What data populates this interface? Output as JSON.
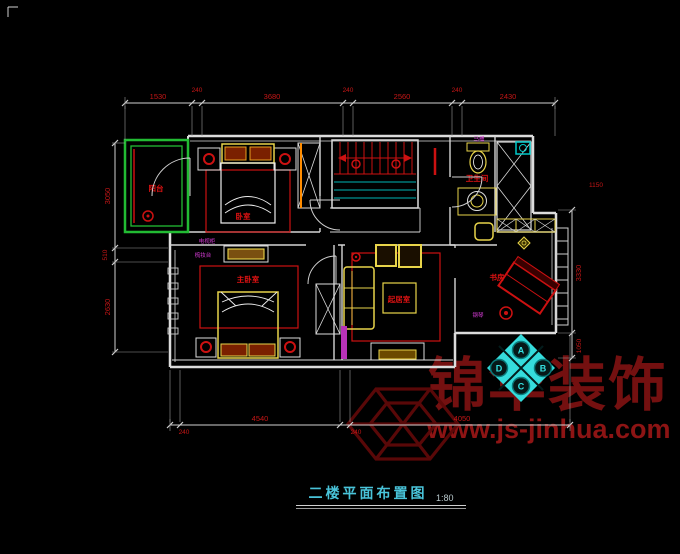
{
  "title": {
    "text": "二楼平面布置图",
    "scale": "1:80"
  },
  "watermark": {
    "brand": "锦华装饰",
    "site": "www.js-jinhua.com"
  },
  "compass": {
    "a": "A",
    "b": "B",
    "c": "C",
    "d": "D"
  },
  "rooms": {
    "balcony": "阳台",
    "bedroom": "卧室",
    "bathroom": "卫生间",
    "study": "书房",
    "family": "起居室",
    "master": "主卧室"
  },
  "annotations": {
    "toilet": "马桶",
    "tv_cabinet": "电视柜",
    "dresser": "梳妆台",
    "piano": "钢琴"
  },
  "dims": {
    "top": [
      "1530",
      "240",
      "3680",
      "240",
      "2560",
      "240",
      "2430"
    ],
    "bottom": [
      "240",
      "4540",
      "240",
      "4050"
    ],
    "left": [
      "3050",
      "510",
      "2630"
    ],
    "right": [
      "3330",
      "1050"
    ],
    "right_top": "1150"
  },
  "colors": {
    "wall": "#dcdcdc",
    "dimension_red": "#c41616",
    "balcony_green": "#22bb33",
    "cad_cyan": "#00c8c8",
    "furniture_yellow": "#e8d44a",
    "furniture_red": "#cc1111",
    "magenta": "#cc33cc",
    "watermark_red": "#741010",
    "title_cyan": "#49c3d9"
  }
}
